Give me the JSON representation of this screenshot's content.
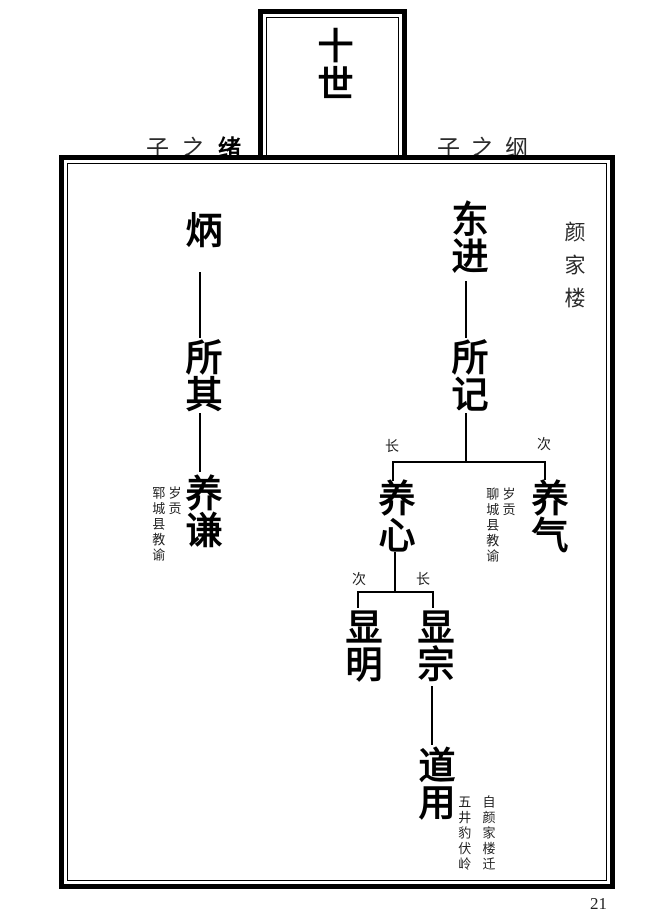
{
  "header": {
    "generation_title": "十世",
    "left_parent_prefix": "子之",
    "left_parent_name": "绪",
    "right_parent_prefix": "子之",
    "right_parent_name": "纲",
    "location": "颜家楼"
  },
  "fork_labels": {
    "fork1_left": "长",
    "fork1_right": "次",
    "fork2_left": "次",
    "fork2_right": "长"
  },
  "left_branch": {
    "gen10": "炳",
    "gen11": "所其",
    "gen12": "养谦",
    "gen12_note_col1": "岁贡",
    "gen12_note_col2": "郓城县教谕"
  },
  "right_branch": {
    "gen10": "东进",
    "gen11": "所记",
    "gen12_elder": "养心",
    "gen12_second": "养气",
    "gen12_second_note_col1": "岁贡",
    "gen12_second_note_col2": "聊城县教谕",
    "gen13_second": "显明",
    "gen13_elder": "显宗",
    "gen14": "道用",
    "gen14_note_col1": "自颜家楼迁",
    "gen14_note_col2": "五井豹伏岭"
  },
  "footer": {
    "page_number": "21"
  }
}
